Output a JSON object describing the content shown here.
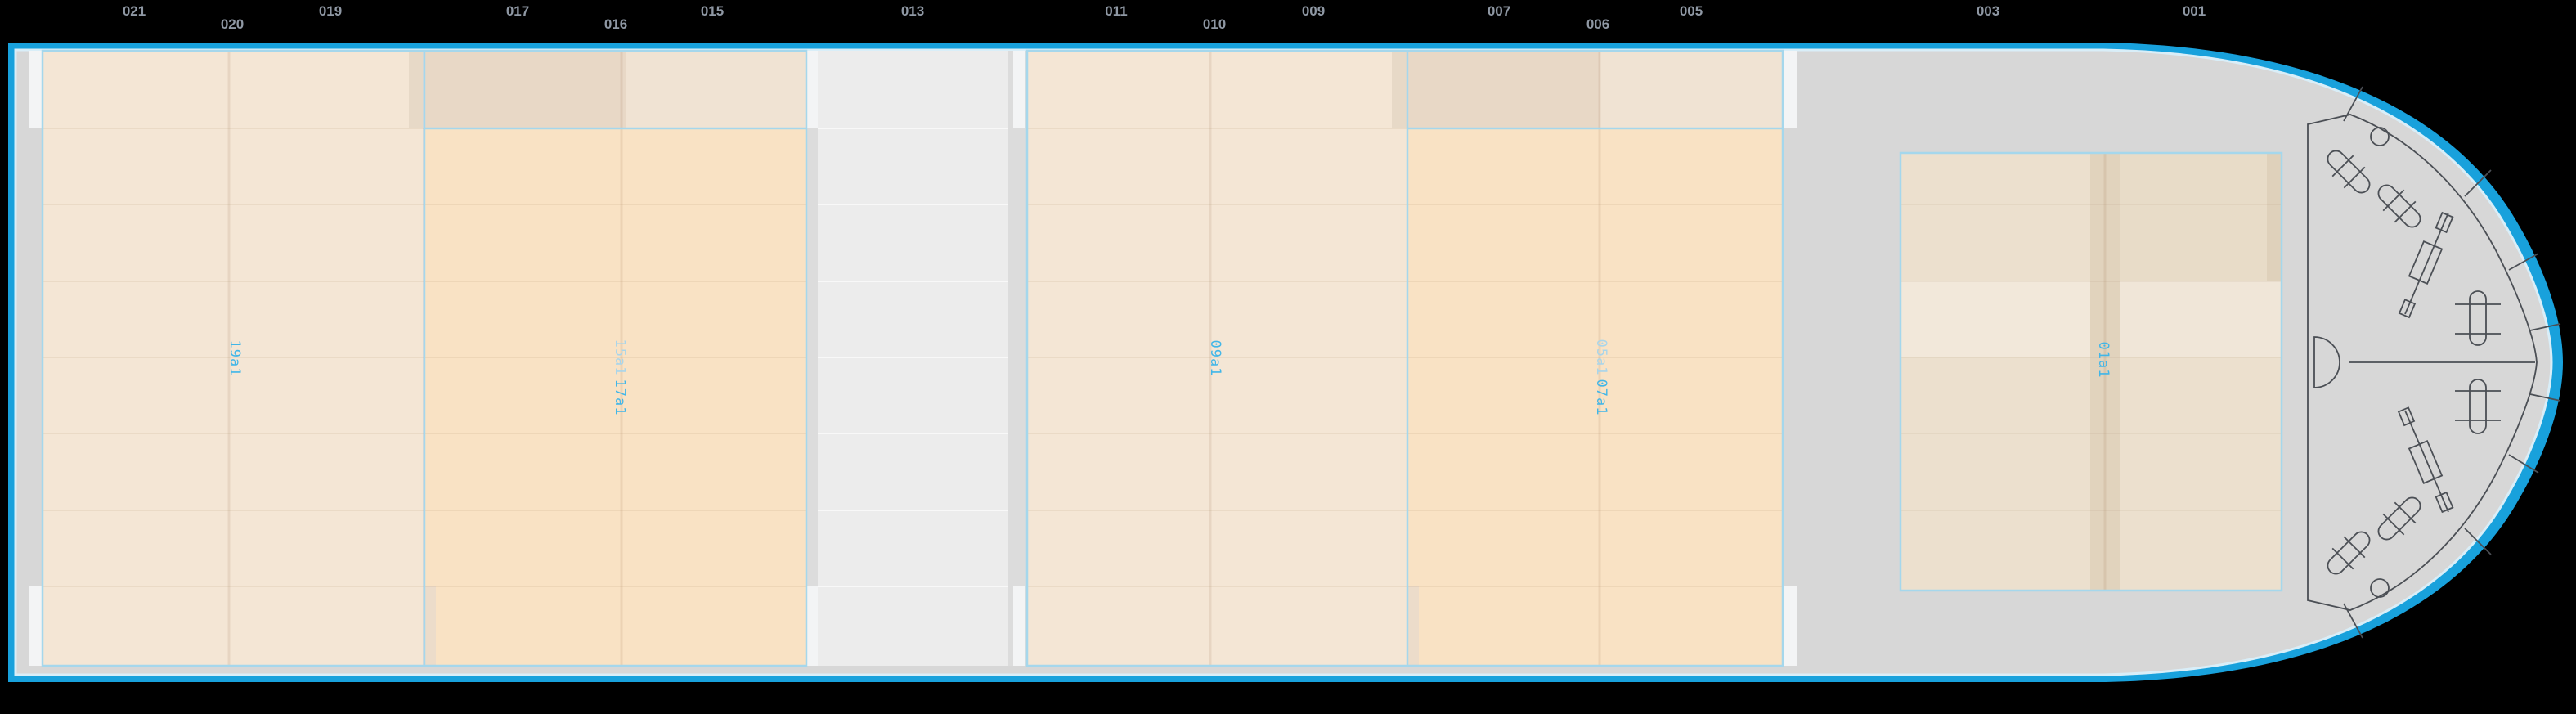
{
  "app": {
    "name": "vessel-deck-bay-plan"
  },
  "palette": {
    "background": "#000000",
    "hull_border": "#18a1dc",
    "hull_inner_line": "#d9eef8",
    "deck": "#d7d7d7",
    "bay_pale": "#f4e6d5",
    "bay_bright": "#f9e2c4",
    "hatch_dark": "#e8d8c6",
    "hatch_light": "#f0e3d3",
    "bay5_base": "#ece0ce",
    "bay5_stripe": "#e1d3bd",
    "panel": "#ececec",
    "gap_column": "#dcdcdc",
    "white_block": "#f3f4f5",
    "label_active": "#41b6e8",
    "label_faded": "#a9d5ea",
    "equipment_line": "#4b4f55"
  },
  "frame_ruler": {
    "color": "#8f98a4",
    "labels": [
      {
        "text": "021"
      },
      {
        "text": "020"
      },
      {
        "text": "019"
      },
      {
        "text": "017"
      },
      {
        "text": "016"
      },
      {
        "text": "015"
      },
      {
        "text": "013"
      },
      {
        "text": "011"
      },
      {
        "text": "010"
      },
      {
        "text": "009"
      },
      {
        "text": "007"
      },
      {
        "text": "006"
      },
      {
        "text": "005"
      },
      {
        "text": "003"
      },
      {
        "text": "001"
      }
    ]
  },
  "bays": {
    "labels": [
      {
        "text": "19a1",
        "state": "active"
      },
      {
        "text": "15a1",
        "state": "faded"
      },
      {
        "text": "17a1",
        "state": "active"
      },
      {
        "text": "09a1",
        "state": "active"
      },
      {
        "text": "05a1",
        "state": "faded"
      },
      {
        "text": "07a1",
        "state": "active"
      },
      {
        "text": "01a1",
        "state": "active"
      }
    ]
  }
}
